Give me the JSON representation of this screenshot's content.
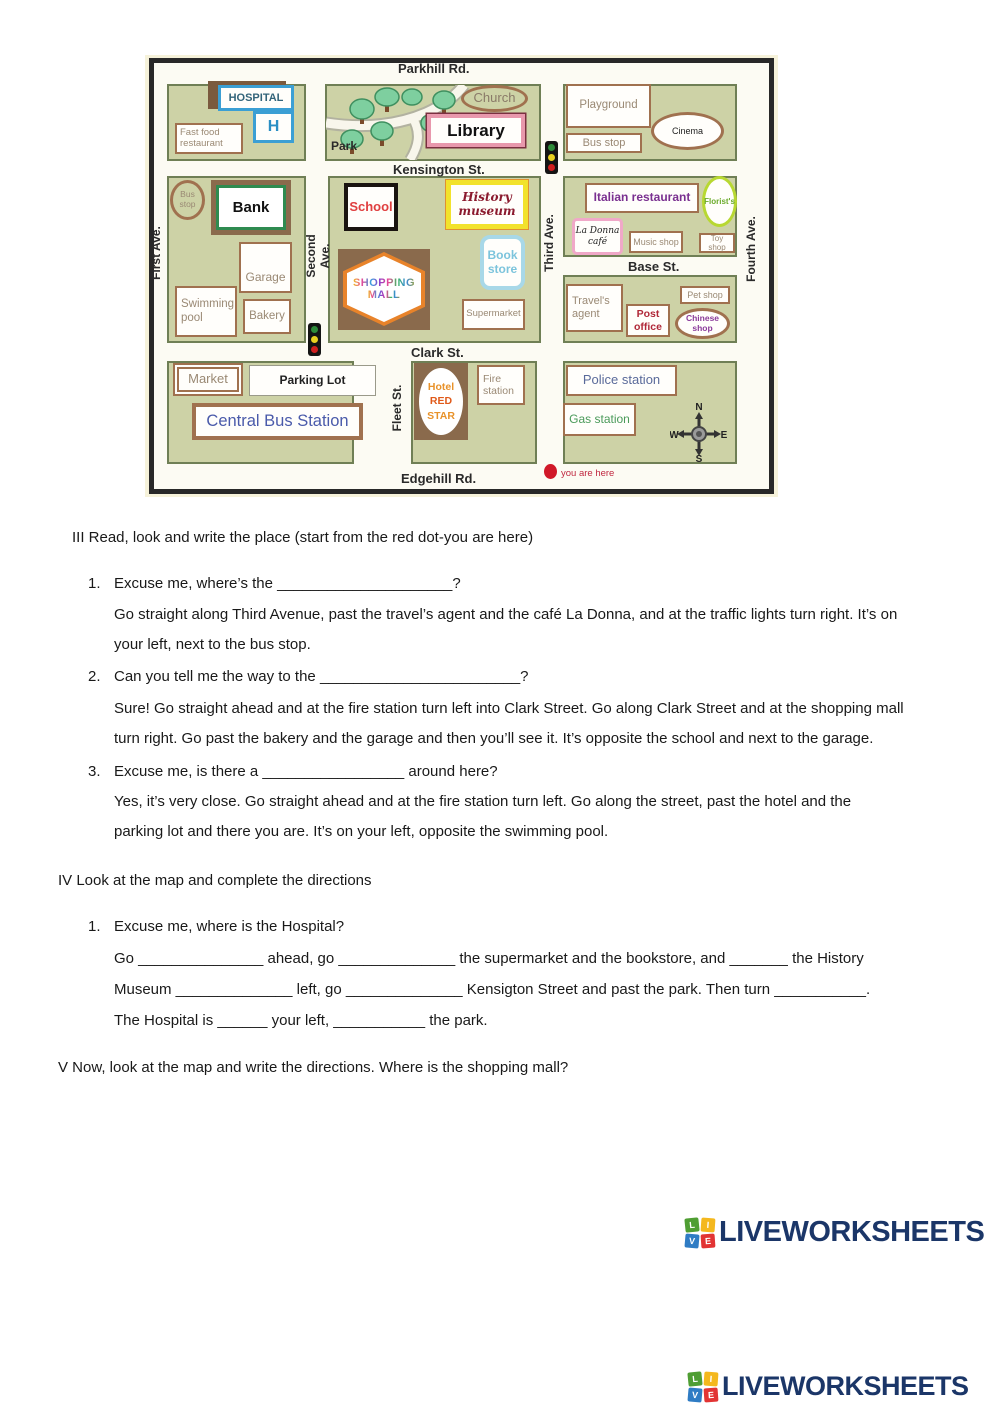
{
  "map": {
    "streets": {
      "parkhill": "Parkhill Rd.",
      "kensington": "Kensington St.",
      "base": "Base St.",
      "clark": "Clark St.",
      "edgehill": "Edgehill Rd.",
      "first_ave": "First Ave.",
      "second_ave": "Second Ave.",
      "third_ave": "Third Ave.",
      "fourth_ave": "Fourth Ave.",
      "fleet": "Fleet St."
    },
    "places": {
      "hospital": "HOSPITAL",
      "hospital_h": "H",
      "fast_food": "Fast food restaurant",
      "park": "Park",
      "church": "Church",
      "library": "Library",
      "playground": "Playground",
      "bus_stop_ne": "Bus stop",
      "cinema": "Cinema",
      "bus_stop_w": "Bus stop",
      "bank": "Bank",
      "school": "School",
      "history_museum": "History museum",
      "book_store": "Book store",
      "garage": "Garage",
      "swimming_pool": "Swimming pool",
      "bakery": "Bakery",
      "shopping_mall_1": "SHOPPING",
      "shopping_mall_2": "MALL",
      "supermarket": "Supermarket",
      "italian_restaurant": "Italian restaurant",
      "florists": "Florist's",
      "la_donna": "La Donna café",
      "music_shop": "Music shop",
      "toy_shop": "Toy shop",
      "travels_agent": "Travel's agent",
      "post_office": "Post office",
      "pet_shop": "Pet shop",
      "chinese_shop": "Chinese shop",
      "market": "Market",
      "parking_lot": "Parking Lot",
      "central_bus_station": "Central Bus Station",
      "hotel_1": "Hotel",
      "hotel_2": "RED",
      "hotel_3": "STAR",
      "fire_station": "Fire station",
      "police_station": "Police station",
      "gas_station": "Gas station"
    },
    "compass": {
      "n": "N",
      "e": "E",
      "s": "S",
      "w": "W"
    },
    "you_are_here": "you are here"
  },
  "sections": {
    "iii": {
      "title": "III Read, look and write the place (start from the red dot-you are here)",
      "items": [
        {
          "num": "1.",
          "q": "Excuse me, where’s the _____________________?",
          "lines": [
            "Go straight along Third Avenue, past the travel’s agent and the café La Donna, and at the traffic lights turn right. It’s on",
            "your left, next to the bus stop."
          ]
        },
        {
          "num": "2.",
          "q": "Can you tell me the way to the ________________________?",
          "lines": [
            "Sure! Go straight ahead and at the fire station turn left into Clark Street. Go along Clark Street and at the shopping mall",
            "turn right. Go past the bakery and the garage and then you’ll see it. It’s opposite the school and next to the garage."
          ]
        },
        {
          "num": "3.",
          "q": "Excuse me, is there a _________________ around here?",
          "lines": [
            "Yes, it’s very close. Go straight ahead and at the fire station turn left. Go along the street, past the hotel and the",
            "parking lot and there you are. It’s on your left, opposite the swimming pool."
          ]
        }
      ]
    },
    "iv": {
      "title": "IV Look at the map and complete the directions",
      "num": "1.",
      "q": "Excuse me, where is the Hospital?",
      "lines": [
        "Go _______________ ahead, go ______________ the supermarket and the bookstore, and _______ the History",
        "Museum ______________ left, go ______________ Kensigton Street and past the park. Then turn ___________.",
        "The Hospital is ______ your left, ___________ the park."
      ]
    },
    "v": {
      "title": "V  Now, look at the map and write the directions. Where is the shopping mall?"
    }
  },
  "logo": {
    "text": "LIVEWORKSHEETS",
    "tiles": [
      {
        "t": "L",
        "c": "#4f9e33"
      },
      {
        "t": "I",
        "c": "#f4b81e"
      },
      {
        "t": "V",
        "c": "#2f7cc4"
      },
      {
        "t": "E",
        "c": "#e23434"
      }
    ]
  },
  "colors": {
    "block_fill": "#cdd2a6",
    "block_border": "#6f7f55",
    "building_border": "#a0714f",
    "building_text": "#9a8974",
    "hospital_blue": "#3b9fd4",
    "bank_green": "#2e8b50",
    "school_red": "#e04040",
    "museum_yellow": "#f2e22c",
    "museum_text": "#8b1a2e",
    "bookstore_blue": "#a8d8e8",
    "mall_orange": "#e8832a",
    "library_pink": "#e898ac",
    "italian_purple": "#7a3090",
    "florist_green": "#b8d832",
    "post_office_red": "#b02838",
    "chinese_purple": "#8a3a9a",
    "police_blue": "#5a6a9a",
    "gas_green": "#4a9a5a",
    "bus_station_blue": "#4a5aaa",
    "hotel_orange": "#e8922a",
    "you_are_here_red": "#cc2233",
    "logo_navy": "#1b3668"
  }
}
